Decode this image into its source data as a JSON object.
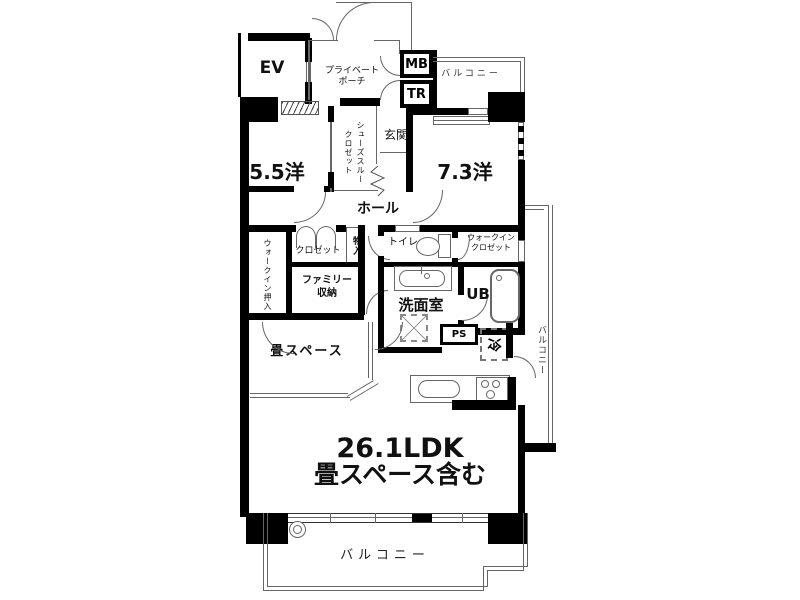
{
  "title": {
    "line1": "26.1LDK",
    "line2": "畳スペース含む"
  },
  "labels": {
    "ev": "EV",
    "private_porch": "プライベート\nポーチ",
    "mail_box": "MB",
    "trunk_room": "TR",
    "balcony_top": "バルコニー",
    "shoes_closet": "シューズスルー\nクロゼット",
    "entrance": "玄関",
    "room_5_5": "5.5洋",
    "room_7_3": "7.3洋",
    "hall": "ホール",
    "walk_in_oshiire": "ウォークイン押入",
    "closet": "クロゼット",
    "storage": "物入",
    "family_storage": "ファミリー\n収納",
    "toilet": "トイレ",
    "walk_in_closet": "ウォークイン\nクロゼット",
    "washroom": "洗面室",
    "unit_bath": "UB",
    "pipe_space": "PS",
    "refrigerator": "冷",
    "tatami_space": "畳スペース",
    "balcony_right": "バルコニー",
    "balcony_bottom": "バルコニー"
  },
  "colors": {
    "wall": "#000000",
    "thin_line": "#666666",
    "text": "#111111",
    "background": "#ffffff"
  }
}
